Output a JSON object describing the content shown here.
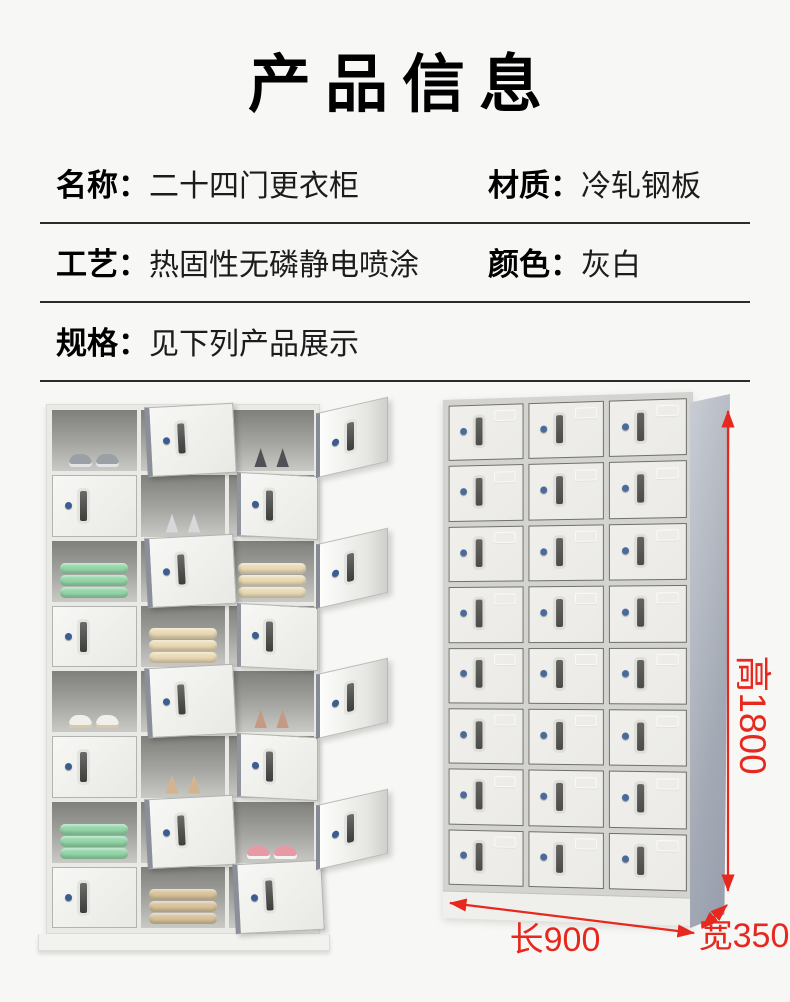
{
  "page": {
    "background": "#f7f7f5"
  },
  "header": {
    "title": "产品信息"
  },
  "specs": {
    "rows": [
      {
        "left": {
          "label": "名称：",
          "value": "二十四门更衣柜"
        },
        "right": {
          "label": "材质：",
          "value": "冷轧钢板"
        }
      },
      {
        "left": {
          "label": "工艺：",
          "value": "热固性无磷静电喷涂"
        },
        "right": {
          "label": "颜色：",
          "value": "灰白"
        }
      },
      {
        "left": {
          "label": "规格：",
          "value": "见下列产品展示"
        }
      }
    ]
  },
  "showcase": {
    "open_locker": {
      "rows": 8,
      "cols": 3,
      "pattern": [
        [
          "open:gray_sneakers",
          "door_out",
          "open_flap:dark_heels"
        ],
        [
          "closed",
          "open:white_heels",
          "ajar"
        ],
        [
          "open:green_towels",
          "door_out",
          "open_flap:beige_towels"
        ],
        [
          "closed",
          "open:beige_towels",
          "ajar"
        ],
        [
          "open:white_sneakers",
          "door_out",
          "open_flap:brown_heels"
        ],
        [
          "closed",
          "open:tan_heels",
          "ajar"
        ],
        [
          "open:green_towels",
          "door_out",
          "open_flap:pink_sneakers"
        ],
        [
          "closed",
          "open:khaki_towels",
          "door_out"
        ]
      ],
      "items": {
        "gray_sneakers": {
          "kind": "sneakers",
          "color": "#9aa0a6",
          "sole": "#e2e4e5"
        },
        "dark_heels": {
          "kind": "heels",
          "color": "#505056"
        },
        "white_heels": {
          "kind": "heels",
          "color": "#d6d8da"
        },
        "green_towels": {
          "kind": "towels",
          "color": "#95d7a9"
        },
        "beige_towels": {
          "kind": "towels",
          "color": "#eadbb6"
        },
        "white_sneakers": {
          "kind": "sneakers",
          "color": "#f0efeb",
          "sole": "#d8c8a6"
        },
        "brown_heels": {
          "kind": "heels",
          "color": "#c49a84"
        },
        "tan_heels": {
          "kind": "heels",
          "color": "#d4b48e"
        },
        "pink_sneakers": {
          "kind": "sneakers",
          "color": "#e79aa4",
          "sole": "#f4f4f2"
        },
        "khaki_towels": {
          "kind": "towels",
          "color": "#d9c49c"
        }
      }
    },
    "closed_locker": {
      "rows": 8,
      "cols": 3,
      "door_color": "#ebeae6",
      "frame_color": "#d3d3cf",
      "side_color": "#a3a9b4",
      "lock_color": "#4a6a9a",
      "handle_color": "#4b4b49"
    },
    "dimensions": {
      "height_label": "高1800",
      "length_label": "长900",
      "width_label": "宽350",
      "color": "#e6281e"
    }
  }
}
